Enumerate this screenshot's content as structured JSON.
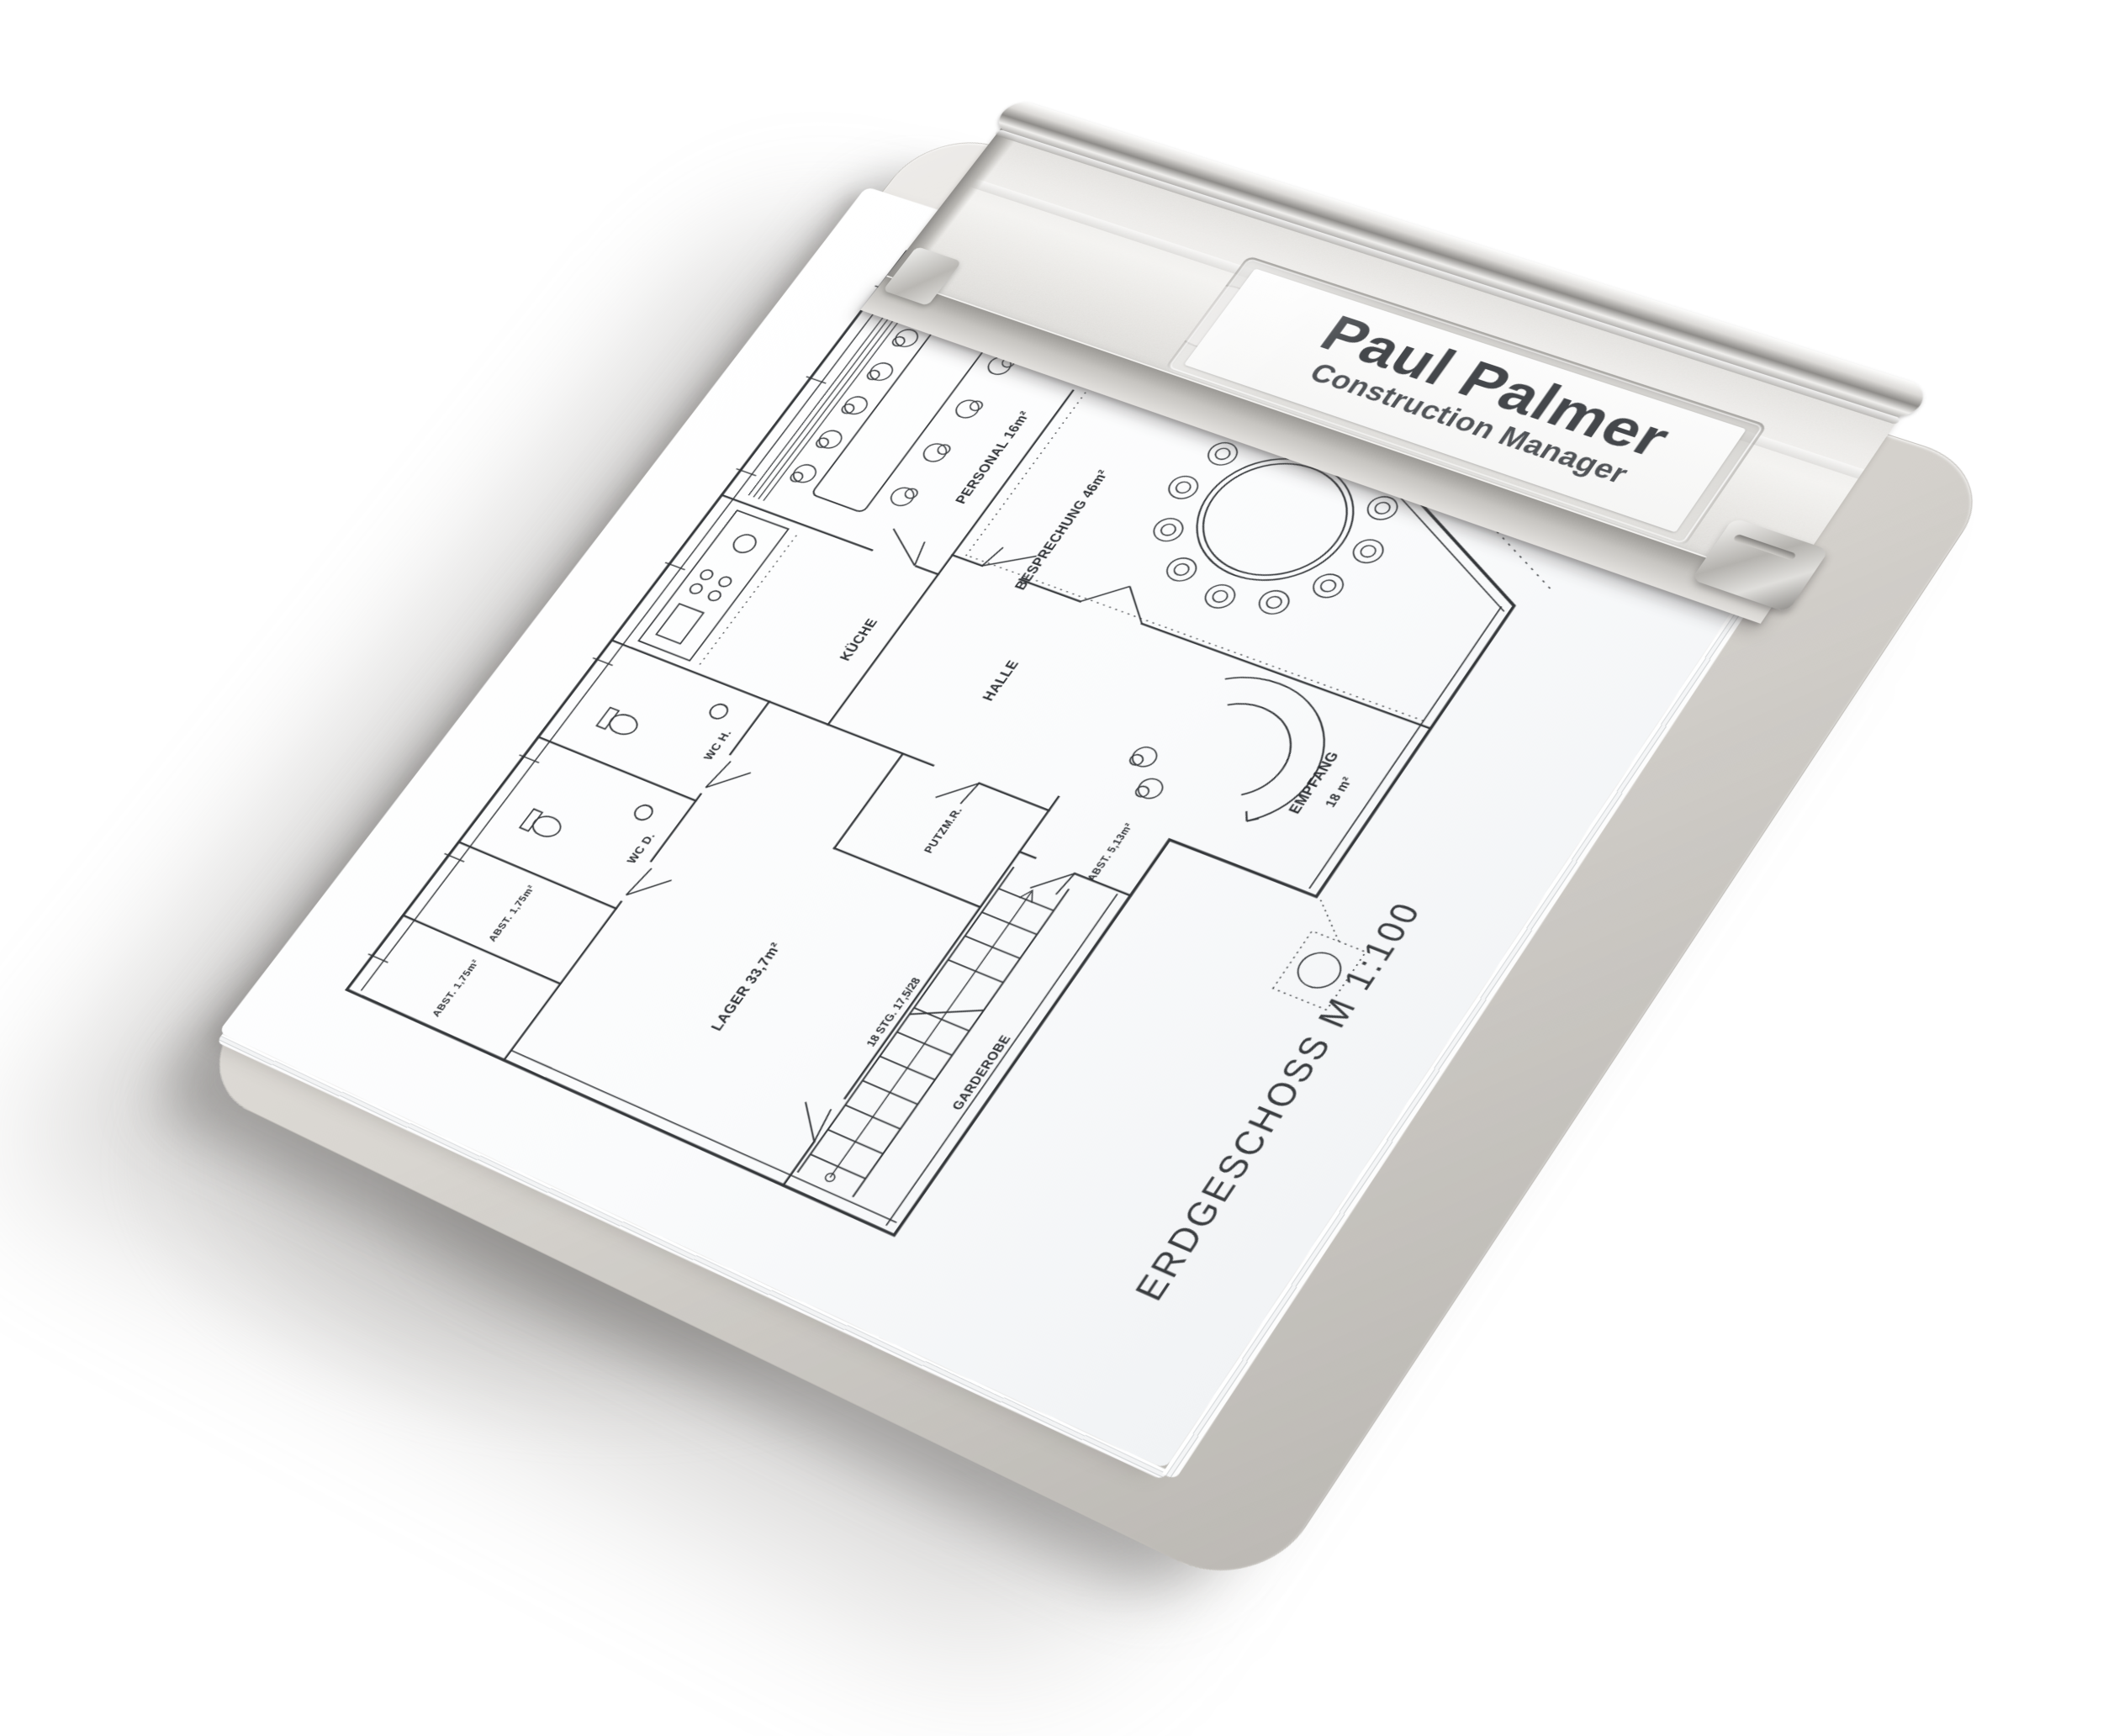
{
  "product_photo": {
    "subject": "Aluminium clipboard with name-plate clip holding a floor-plan sheet",
    "clip_label": {
      "name": "Paul Palmer",
      "title": "Construction Manager"
    },
    "floor_plan": {
      "sheet_title": "ERDGESCHOSS M 1:100",
      "stair_note": "18 STG. 17,5/28",
      "room_labels": [
        "PERSONAL 16m²",
        "KÜCHE",
        "HALLE",
        "BESPRECHUNG 46m²",
        "EMPFANG",
        "18 m²",
        "GARDEROBE",
        "WC D.",
        "WC H.",
        "ABST. 1,75m²",
        "ABST. 1,75m²",
        "LAGER 33,7m²",
        "PUTZM.R.",
        "ABST. 5,13m²"
      ]
    },
    "colors": {
      "background": "#ffffff",
      "board": "#d7d4cf",
      "clip_metal": "#e6e4e1",
      "clip_dark_band": "#9b9995",
      "paper": "#fbfcfd",
      "plan_ink": "#34373a",
      "label_text": "#44474b",
      "cast_shadow": "#b2b0ad"
    }
  }
}
